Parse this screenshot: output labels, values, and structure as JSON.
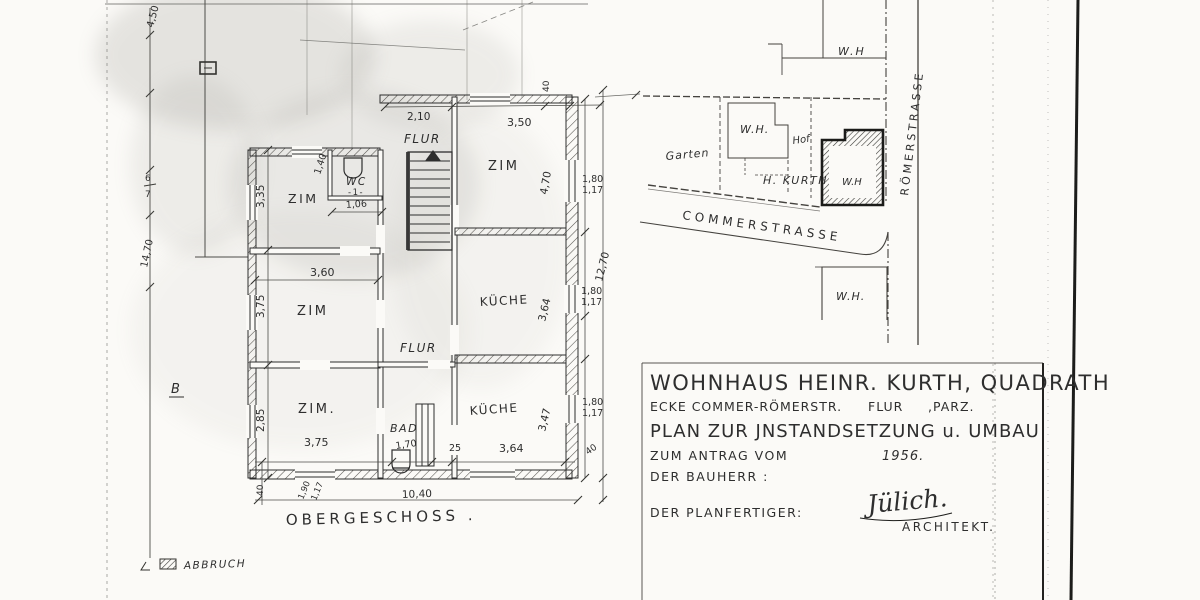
{
  "colors": {
    "ink": "#2e2e2e",
    "faint": "#6a6a66",
    "paper": "#fbfaf7"
  },
  "margin_dims": {
    "top": "4,50",
    "mid_a": "6",
    "mid_b": "7",
    "bottom": "14,70"
  },
  "floor_plan": {
    "caption": "OBERGESCHOSS .",
    "section_label": "B",
    "rooms": {
      "flur_top": "FLUR",
      "zim_ne": "ZIM",
      "wc": "WC",
      "wc_no": "-1-",
      "zim_nw": "ZIM",
      "zim_w": "ZIM",
      "kueche_ne": "KÜCHE",
      "flur_mid": "FLUR",
      "zim_sw": "ZIM.",
      "bad": "BAD",
      "kueche_se": "KÜCHE"
    },
    "dims": {
      "top_40": "40",
      "flur_w": "2,10",
      "zim_ne_w": "3,50",
      "zim_ne_h": "4,70",
      "r1a": "1,80",
      "r1b": "1,17",
      "wc_h": "1,40",
      "zim_nw_h": "3,35",
      "wc_w": "1,06",
      "zim_w_w": "3,60",
      "right_total": "12,70",
      "zim_w_h": "3,75",
      "kueche_ne_h": "3,64",
      "r2a": "1,80",
      "r2b": "1,17",
      "zim_sw_h": "2,85",
      "kueche_se_h": "3,47",
      "r3a": "1,80",
      "r3b": "1,17",
      "zim_sw_w": "3,75",
      "bad_w": "1,70",
      "mid_25": "25",
      "kueche_se_w": "3,64",
      "se_40": "40",
      "sw_40": "40",
      "sw_190": "1,90",
      "sw_117": "1,17",
      "total_w": "10,40"
    }
  },
  "site_plan": {
    "streets": {
      "roemer": "RÖMERSTRASSE",
      "commer": "COMMERSTRASSE"
    },
    "labels": {
      "wh_top": "W.H",
      "wh_left": "W.H.",
      "hof": "Hof",
      "garten": "Garten",
      "kurth": "H. KURTH",
      "wh_corner": "W.H",
      "wh_south": "W.H."
    }
  },
  "legend": {
    "abbruch": "ABBRUCH"
  },
  "title_block": {
    "line1": "WOHNHAUS HEINR. KURTH, QUADRATH",
    "line2a": "ECKE COMMER-RÖMERSTR.",
    "line2b": "FLUR",
    "line2c": ",PARZ.",
    "line3": "PLAN ZUR JNSTANDSETZUNG u. UMBAU",
    "line4a": "ZUM ANTRAG VOM",
    "line4b": "1956.",
    "line5": "DER BAUHERR :",
    "line6": "DER PLANFERTIGER:",
    "signature": "Jülich.",
    "architect": "ARCHITEKT."
  }
}
